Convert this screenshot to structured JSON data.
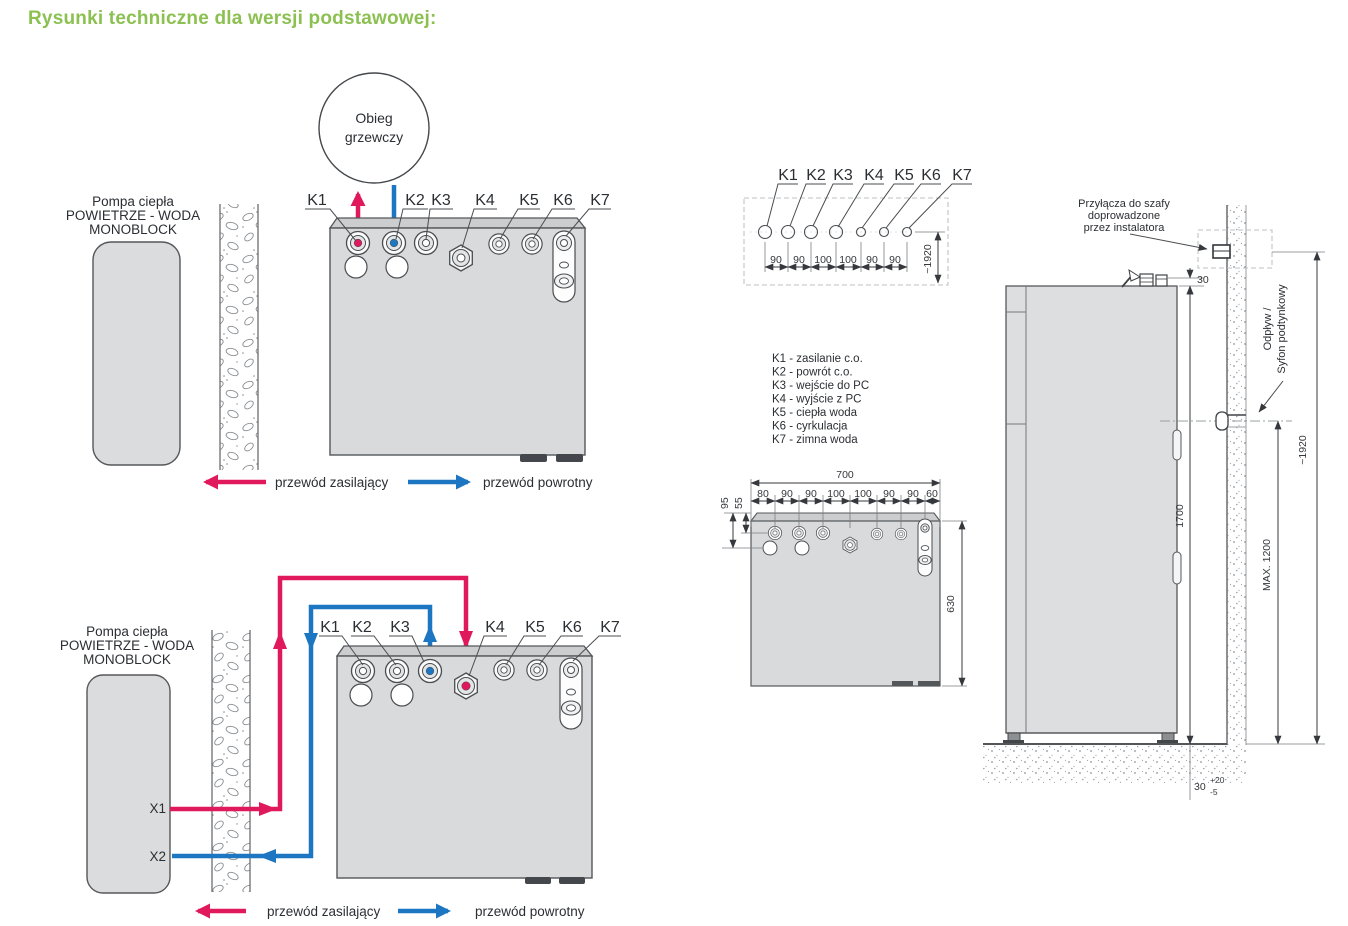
{
  "page": {
    "title": "Rysunki techniczne dla wersji podstawowej:"
  },
  "labels": {
    "pump": [
      "Pompa ciepła",
      "POWIETRZE - WODA",
      "MONOBLOCK"
    ],
    "heating_circuit": [
      "Obieg",
      "grzewczy"
    ],
    "ports": [
      "K1",
      "K2",
      "K3",
      "K4",
      "K5",
      "K6",
      "K7"
    ],
    "pump_ports": [
      "X1",
      "X2"
    ],
    "legend_supply": "przewód zasilający",
    "legend_return": "przewód powrotny"
  },
  "port_descriptions": [
    "K1 - zasilanie c.o.",
    "K2 - powrót c.o.",
    "K3 - wejście do PC",
    "K4 - wyjście z PC",
    "K5 - ciepła woda",
    "K6 - cyrkulacja",
    "K7 - zimna woda"
  ],
  "top_view": {
    "spacings": [
      "90",
      "90",
      "100",
      "100",
      "90",
      "90"
    ],
    "total": "~1920"
  },
  "front_dims": {
    "width": "700",
    "offsets": [
      "80",
      "90",
      "90",
      "100",
      "100",
      "90",
      "90",
      "60"
    ],
    "row_offset_1": "95",
    "row_offset_2": "55",
    "height": "630"
  },
  "side_view": {
    "installer_note": [
      "Przyłącza do szafy",
      "doprowadzone",
      "przez instalatora"
    ],
    "drain_label": [
      "Odpływ /",
      "Syfon podtynkowy"
    ],
    "dim_top_gap": "30",
    "dim_height": "1700",
    "dim_max": "MAX. 1200",
    "dim_total": "~1920",
    "dim_floor": "30",
    "dim_floor_plus": "+20",
    "dim_floor_minus": "-5"
  },
  "colors": {
    "title_green": "#8cc152",
    "supply_red": "#e0185c",
    "return_blue": "#1c76c1"
  }
}
